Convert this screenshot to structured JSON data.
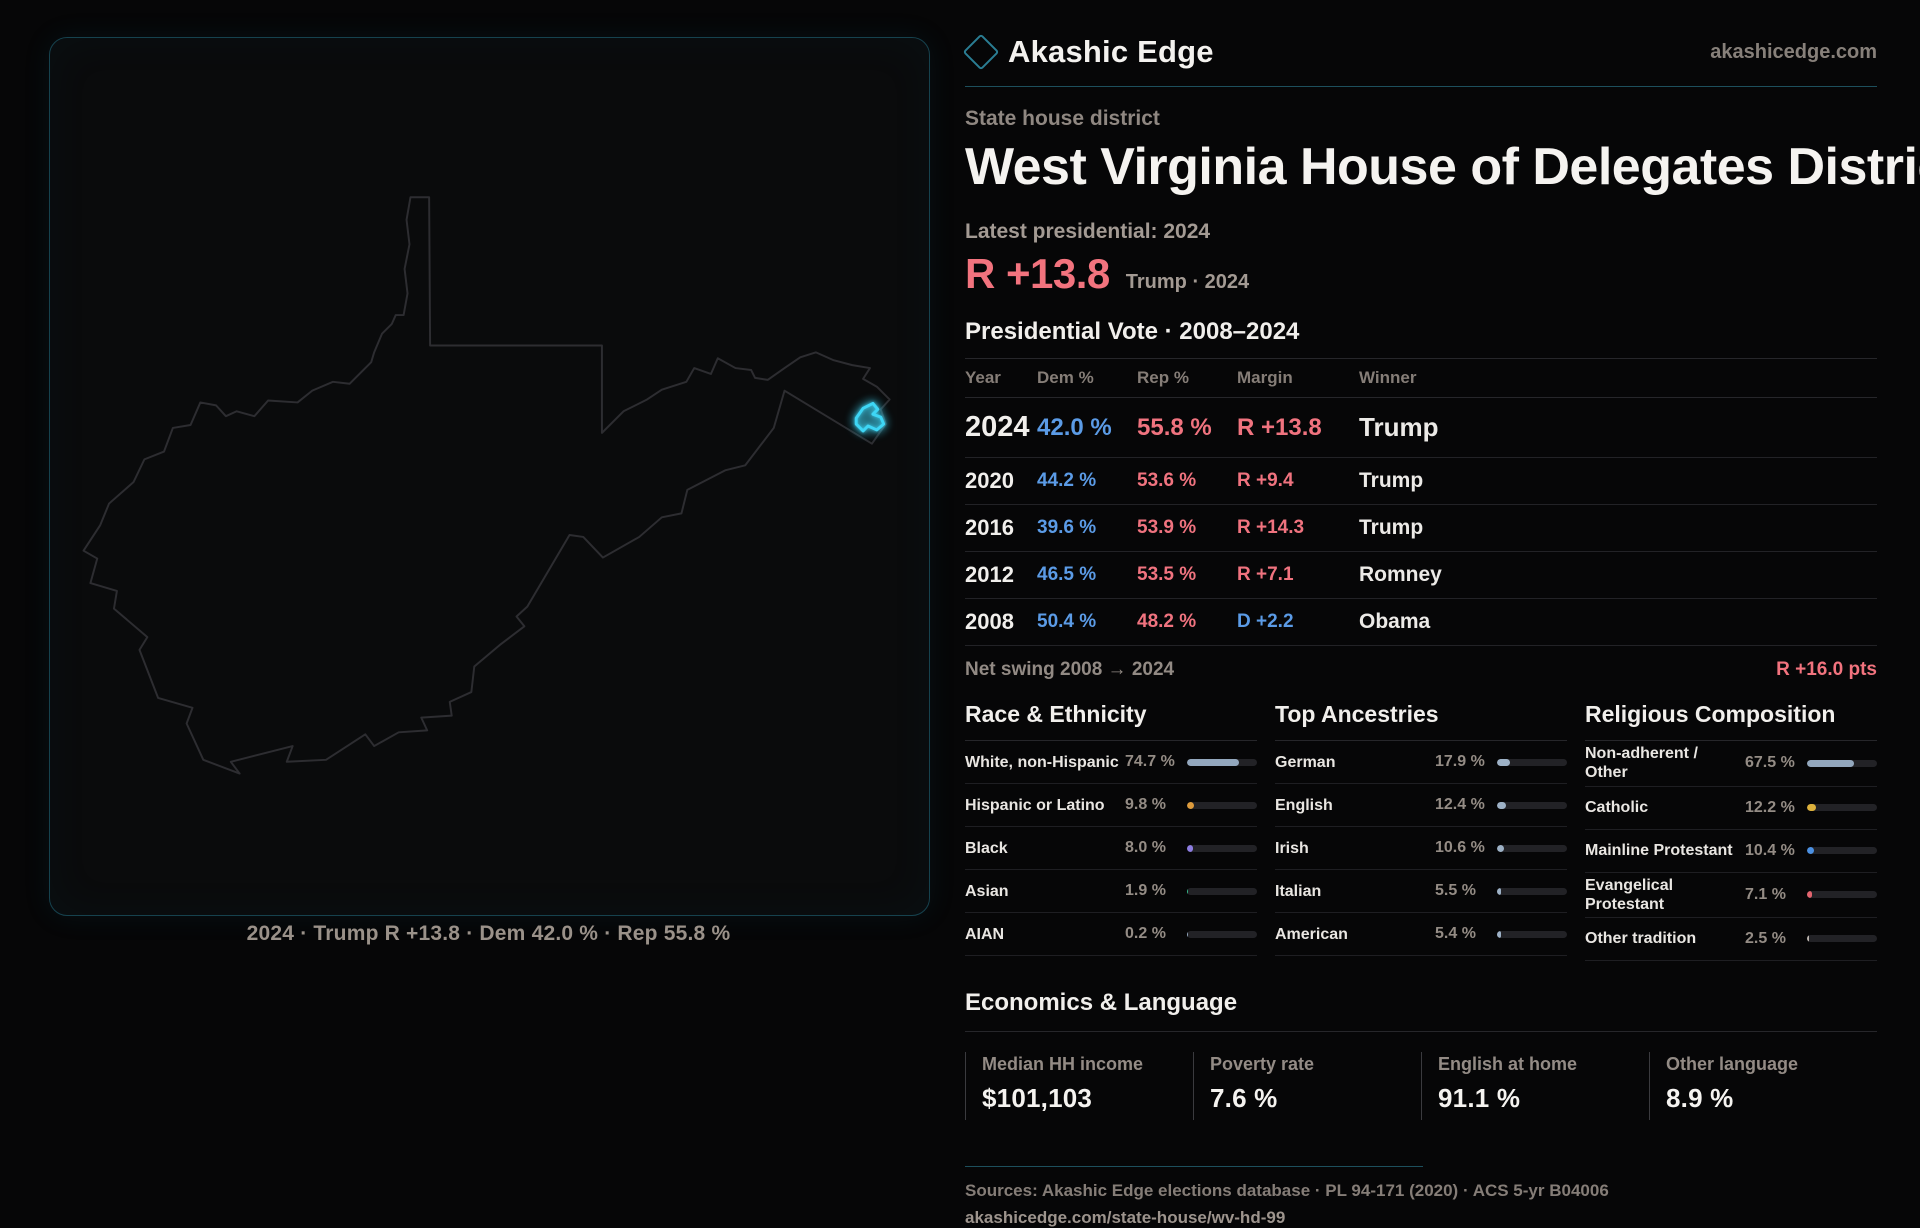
{
  "header": {
    "brand": "Akashic Edge",
    "site": "akashicedge.com"
  },
  "map": {
    "caption": "2024 · Trump R +13.8 · Dem 42.0 % · Rep 55.8 %",
    "outline_color": "#2d2d31",
    "district_color": "#3ed6f5"
  },
  "hero": {
    "kicker": "State house district",
    "title": "West Virginia House of Delegates District 99",
    "latest_label": "Latest presidential: 2024",
    "margin_value": "R +13.8",
    "margin_note": "Trump · 2024"
  },
  "vote_table": {
    "heading": "Presidential Vote · 2008–2024",
    "columns": [
      "Year",
      "Dem %",
      "Rep %",
      "Margin",
      "Winner"
    ],
    "rows": [
      {
        "year": "2024",
        "dem": "42.0 %",
        "rep": "55.8 %",
        "margin": "R +13.8",
        "winner": "Trump"
      },
      {
        "year": "2020",
        "dem": "44.2 %",
        "rep": "53.6 %",
        "margin": "R +9.4",
        "winner": "Trump"
      },
      {
        "year": "2016",
        "dem": "39.6 %",
        "rep": "53.9 %",
        "margin": "R +14.3",
        "winner": "Trump"
      },
      {
        "year": "2012",
        "dem": "46.5 %",
        "rep": "53.5 %",
        "margin": "R +7.1",
        "winner": "Romney"
      },
      {
        "year": "2008",
        "dem": "50.4 %",
        "rep": "48.2 %",
        "margin": "D +2.2",
        "winner": "Obama"
      }
    ],
    "net_swing_label": "Net swing 2008 → 2024",
    "net_swing_value": "R +16.0 pts"
  },
  "demographics": {
    "race": {
      "heading": "Race & Ethnicity",
      "rows": [
        {
          "label": "White, non-Hispanic",
          "value": "74.7 %",
          "pct": 74.7,
          "color": "#93a7bd"
        },
        {
          "label": "Hispanic or Latino",
          "value": "9.8 %",
          "pct": 9.8,
          "color": "#dd9b3c"
        },
        {
          "label": "Black",
          "value": "8.0 %",
          "pct": 8.0,
          "color": "#8d7de2"
        },
        {
          "label": "Asian",
          "value": "1.9 %",
          "pct": 1.9,
          "color": "#35b98a"
        },
        {
          "label": "AIAN",
          "value": "0.2 %",
          "pct": 0.2,
          "color": "#93a7bd"
        }
      ]
    },
    "ancestries": {
      "heading": "Top Ancestries",
      "rows": [
        {
          "label": "German",
          "value": "17.9 %",
          "pct": 17.9,
          "color": "#9db1c6"
        },
        {
          "label": "English",
          "value": "12.4 %",
          "pct": 12.4,
          "color": "#9db1c6"
        },
        {
          "label": "Irish",
          "value": "10.6 %",
          "pct": 10.6,
          "color": "#9db1c6"
        },
        {
          "label": "Italian",
          "value": "5.5 %",
          "pct": 5.5,
          "color": "#9db1c6"
        },
        {
          "label": "American",
          "value": "5.4 %",
          "pct": 5.4,
          "color": "#9db1c6"
        }
      ]
    },
    "religion": {
      "heading": "Religious Composition",
      "rows": [
        {
          "label": "Non-adherent / Other",
          "value": "67.5 %",
          "pct": 67.5,
          "color": "#93a7bd"
        },
        {
          "label": "Catholic",
          "value": "12.2 %",
          "pct": 12.2,
          "color": "#ddb13c"
        },
        {
          "label": "Mainline Protestant",
          "value": "10.4 %",
          "pct": 10.4,
          "color": "#4b90e2"
        },
        {
          "label": "Evangelical Protestant",
          "value": "7.1 %",
          "pct": 7.1,
          "color": "#e2646e"
        },
        {
          "label": "Other tradition",
          "value": "2.5 %",
          "pct": 2.5,
          "color": "#b9b2ac"
        }
      ]
    }
  },
  "economics": {
    "heading": "Economics & Language",
    "stats": [
      {
        "label": "Median HH income",
        "value": "$101,103"
      },
      {
        "label": "Poverty rate",
        "value": "7.6 %"
      },
      {
        "label": "English at home",
        "value": "91.1 %"
      },
      {
        "label": "Other language",
        "value": "8.9 %"
      }
    ]
  },
  "footer": {
    "sources": "Sources: Akashic Edge elections database · PL 94-171 (2020) · ACS 5-yr B04006",
    "permalink": "akashicedge.com/state-house/wv-hd-99"
  }
}
